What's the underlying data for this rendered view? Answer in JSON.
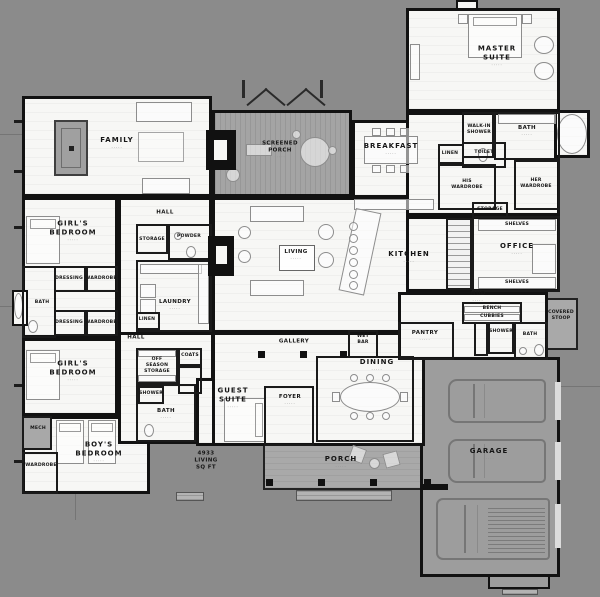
{
  "palette": {
    "background": "#8b8b8b",
    "paper": "#f7f7f5",
    "wall": "#111111",
    "deck": "#a4a4a4",
    "garage_overlay": "#9d9d9d"
  },
  "ui": {
    "dims_illegible": "·····"
  },
  "area_note": {
    "line1": "4933",
    "line2": "LIVING",
    "line3": "SQ FT"
  },
  "rooms": {
    "family": "FAMILY",
    "screened_porch": "SCREENED PORCH",
    "breakfast": "BREAKFAST",
    "master_suite": "MASTER SUITE",
    "bath": "BATH",
    "walk_in_shower": "WALK-IN SHOWER",
    "toilet": "TOILET",
    "linen": "LINEN",
    "his_wardrobe": "HIS WARDROBE",
    "her_wardrobe": "HER WARDROBE",
    "storage": "STORAGE",
    "office": "OFFICE",
    "shelves": "SHELVES",
    "mud": "MUD",
    "bench": "BENCH",
    "cubbies": "CUBBIES",
    "pantry": "PANTRY",
    "shower": "SHOWER",
    "covered_stoop": "COVERED STOOP",
    "kitchen": "KITCHEN",
    "living": "LIVING",
    "hall": "HALL",
    "powder": "POWDER",
    "laundry": "LAUNDRY",
    "girls_bedroom": "GIRL'S BEDROOM",
    "dressing": "DRESSING",
    "wardrobe": "WARDROBE",
    "off_season_storage": "OFF SEASON STORAGE",
    "coats": "COATS",
    "boys_bedroom": "BOY'S BEDROOM",
    "mech": "MECH",
    "guest_suite": "GUEST SUITE",
    "gallery": "GALLERY",
    "wet_bar": "WET BAR",
    "foyer": "FOYER",
    "dining": "DINING",
    "porch": "PORCH",
    "garage": "GARAGE"
  }
}
